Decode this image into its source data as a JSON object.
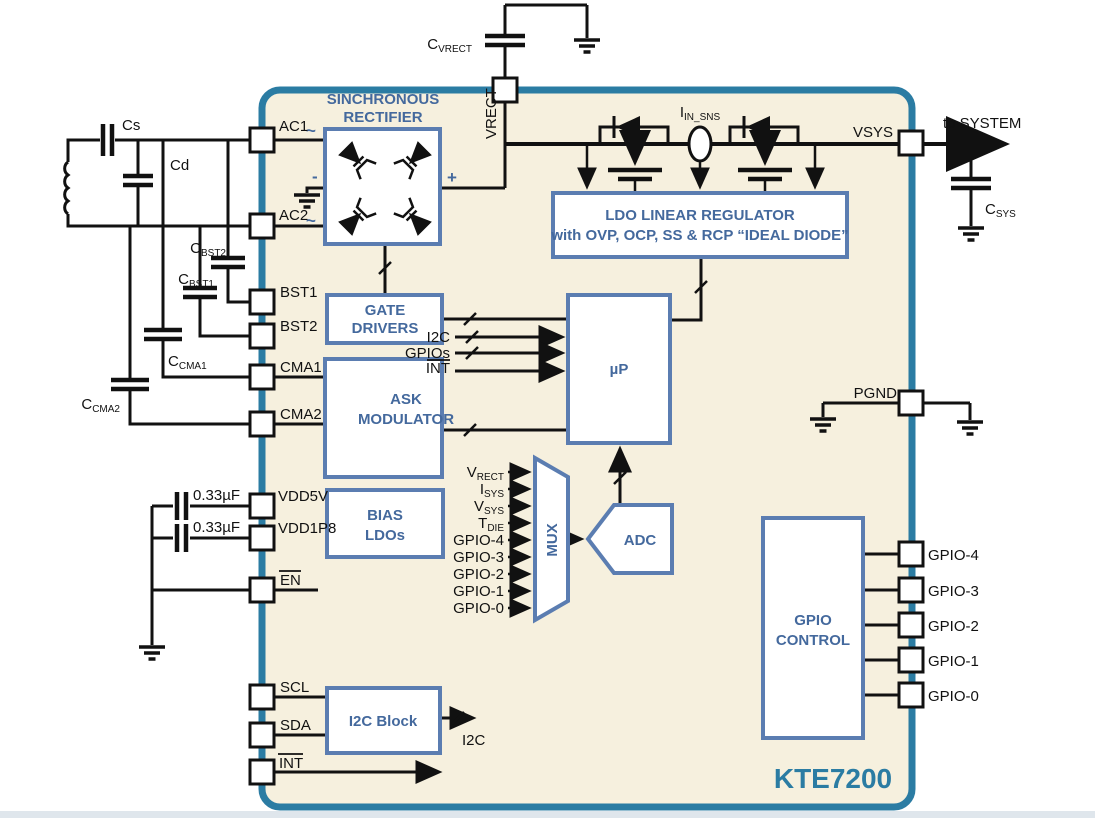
{
  "chip": {
    "name": "KTE7200"
  },
  "colors": {
    "chip_border": "#2b7ca3",
    "chip_fill": "#f6f0de",
    "block_border": "#5b7db1",
    "block_text": "#44699d",
    "wire": "#111111"
  },
  "blocks": {
    "rectifier": {
      "line1": "SINCHRONOUS",
      "line2": "RECTIFIER",
      "plus": "+",
      "minus": "-",
      "tilde_top": "~",
      "tilde_bottom": "~"
    },
    "gate_drivers": {
      "line1": "GATE",
      "line2": "DRIVERS"
    },
    "ask": {
      "line1": "ASK",
      "line2": "MODULATOR"
    },
    "bias": {
      "line1": "BIAS",
      "line2": "LDOs"
    },
    "i2c_block": {
      "label": "I2C Block"
    },
    "ldo": {
      "line1": "LDO LINEAR REGULATOR",
      "line2": "with OVP, OCP, SS & RCP “IDEAL DIODE”"
    },
    "up": {
      "label": "µP"
    },
    "mux": {
      "label": "MUX"
    },
    "adc": {
      "label": "ADC"
    },
    "gpio_control": {
      "line1": "GPIO",
      "line2": "CONTROL"
    }
  },
  "pins": {
    "ac1": "AC1",
    "ac2": "AC2",
    "bst1": "BST1",
    "bst2": "BST2",
    "cma1": "CMA1",
    "cma2": "CMA2",
    "vdd5v": "VDD5V",
    "vdd1p8": "VDD1P8",
    "en": "EN",
    "scl": "SCL",
    "sda": "SDA",
    "int": "INT",
    "vrect": "VRECT",
    "vsys": "VSYS",
    "pgnd": "PGND",
    "gpio4": "GPIO-4",
    "gpio3": "GPIO-3",
    "gpio2": "GPIO-2",
    "gpio1": "GPIO-1",
    "gpio0": "GPIO-0"
  },
  "components": {
    "cs": "Cs",
    "cd": "Cd",
    "cbst1": {
      "main": "C",
      "sub": "BST1"
    },
    "cbst2": {
      "main": "C",
      "sub": "BST2"
    },
    "ccma1": {
      "main": "C",
      "sub": "CMA1"
    },
    "ccma2": {
      "main": "C",
      "sub": "CMA2"
    },
    "cvrect": {
      "main": "C",
      "sub": "VRECT"
    },
    "csys": {
      "main": "C",
      "sub": "SYS"
    },
    "cap_vdd5v": "0.33µF",
    "cap_vdd1p8": "0.33µF"
  },
  "signals": {
    "iin_sns": {
      "main": "I",
      "sub": "IN_SNS"
    },
    "to_system": "to SYSTEM",
    "i2c_to_up": "I2C",
    "gpios_to_up": "GPIOs",
    "int_to_up": "INT",
    "i2c_out": "I2C",
    "mux_in": [
      {
        "main": "V",
        "sub": "RECT"
      },
      {
        "main": "I",
        "sub": "SYS"
      },
      {
        "main": "V",
        "sub": "SYS"
      },
      {
        "main": "T",
        "sub": "DIE"
      },
      {
        "main": "GPIO-4",
        "sub": ""
      },
      {
        "main": "GPIO-3",
        "sub": ""
      },
      {
        "main": "GPIO-2",
        "sub": ""
      },
      {
        "main": "GPIO-1",
        "sub": ""
      },
      {
        "main": "GPIO-0",
        "sub": ""
      }
    ]
  }
}
